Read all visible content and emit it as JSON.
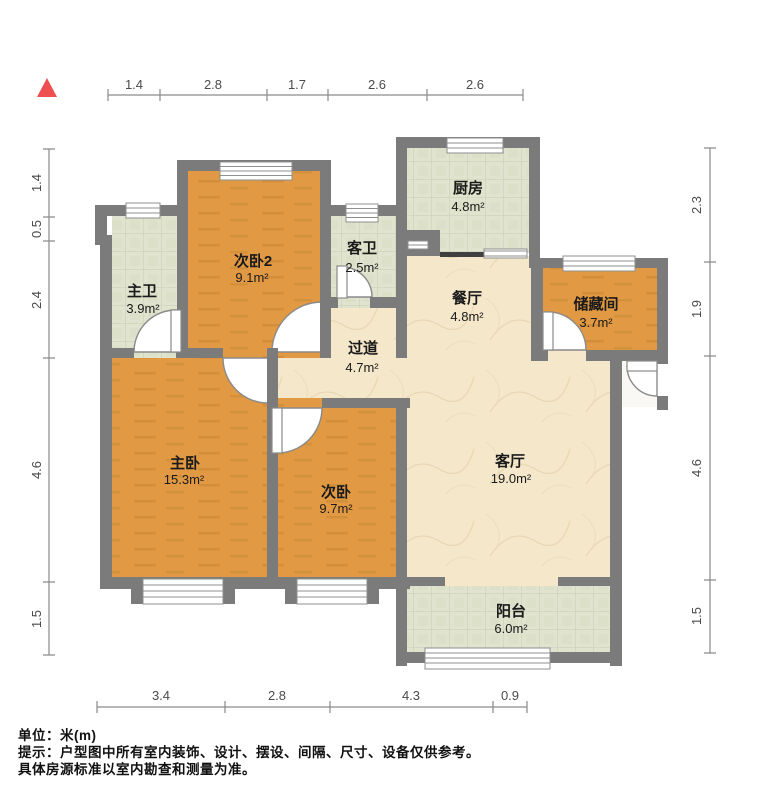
{
  "title": "户型图",
  "unit": "米(m)",
  "north_indicator": "north-arrow",
  "dimensions": {
    "top": [
      "1.4",
      "2.8",
      "1.7",
      "2.6",
      "2.6"
    ],
    "bottom": [
      "3.4",
      "2.8",
      "4.3",
      "0.9"
    ],
    "left": [
      "1.4",
      "0.5",
      "2.4",
      "4.6",
      "1.5"
    ],
    "right": [
      "2.3",
      "1.9",
      "4.6",
      "1.5"
    ]
  },
  "rooms": [
    {
      "id": "bedroom2",
      "name": "次卧2",
      "area": "9.1m²"
    },
    {
      "id": "guest-bathroom",
      "name": "客卫",
      "area": "2.5m²"
    },
    {
      "id": "kitchen",
      "name": "厨房",
      "area": "4.8m²"
    },
    {
      "id": "master-bathroom",
      "name": "主卫",
      "area": "3.9m²"
    },
    {
      "id": "dining-room",
      "name": "餐厅",
      "area": "4.8m²"
    },
    {
      "id": "storage-room",
      "name": "储藏间",
      "area": "3.7m²"
    },
    {
      "id": "hallway",
      "name": "过道",
      "area": "4.7m²"
    },
    {
      "id": "master-bedroom",
      "name": "主卧",
      "area": "15.3m²"
    },
    {
      "id": "bedroom",
      "name": "次卧",
      "area": "9.7m²"
    },
    {
      "id": "living-room",
      "name": "客厅",
      "area": "19.0m²"
    },
    {
      "id": "balcony",
      "name": "阳台",
      "area": "6.0m²"
    }
  ],
  "footer": {
    "unit_line": "单位：米(m)",
    "tip_line1": "提示：户型图中所有室内装饰、设计、摆设、间隔、尺寸、设备仅供参考。",
    "tip_line2": "具体房源标准以室内勘查和测量为准。"
  },
  "colors": {
    "wall": "#7b7b7b",
    "wood_floor": "#e19943",
    "tile_floor": "#e0e3cd",
    "marble_floor": "#f4e7ca",
    "north_red": "#ee5052",
    "dim_line": "#8a8a8a"
  }
}
